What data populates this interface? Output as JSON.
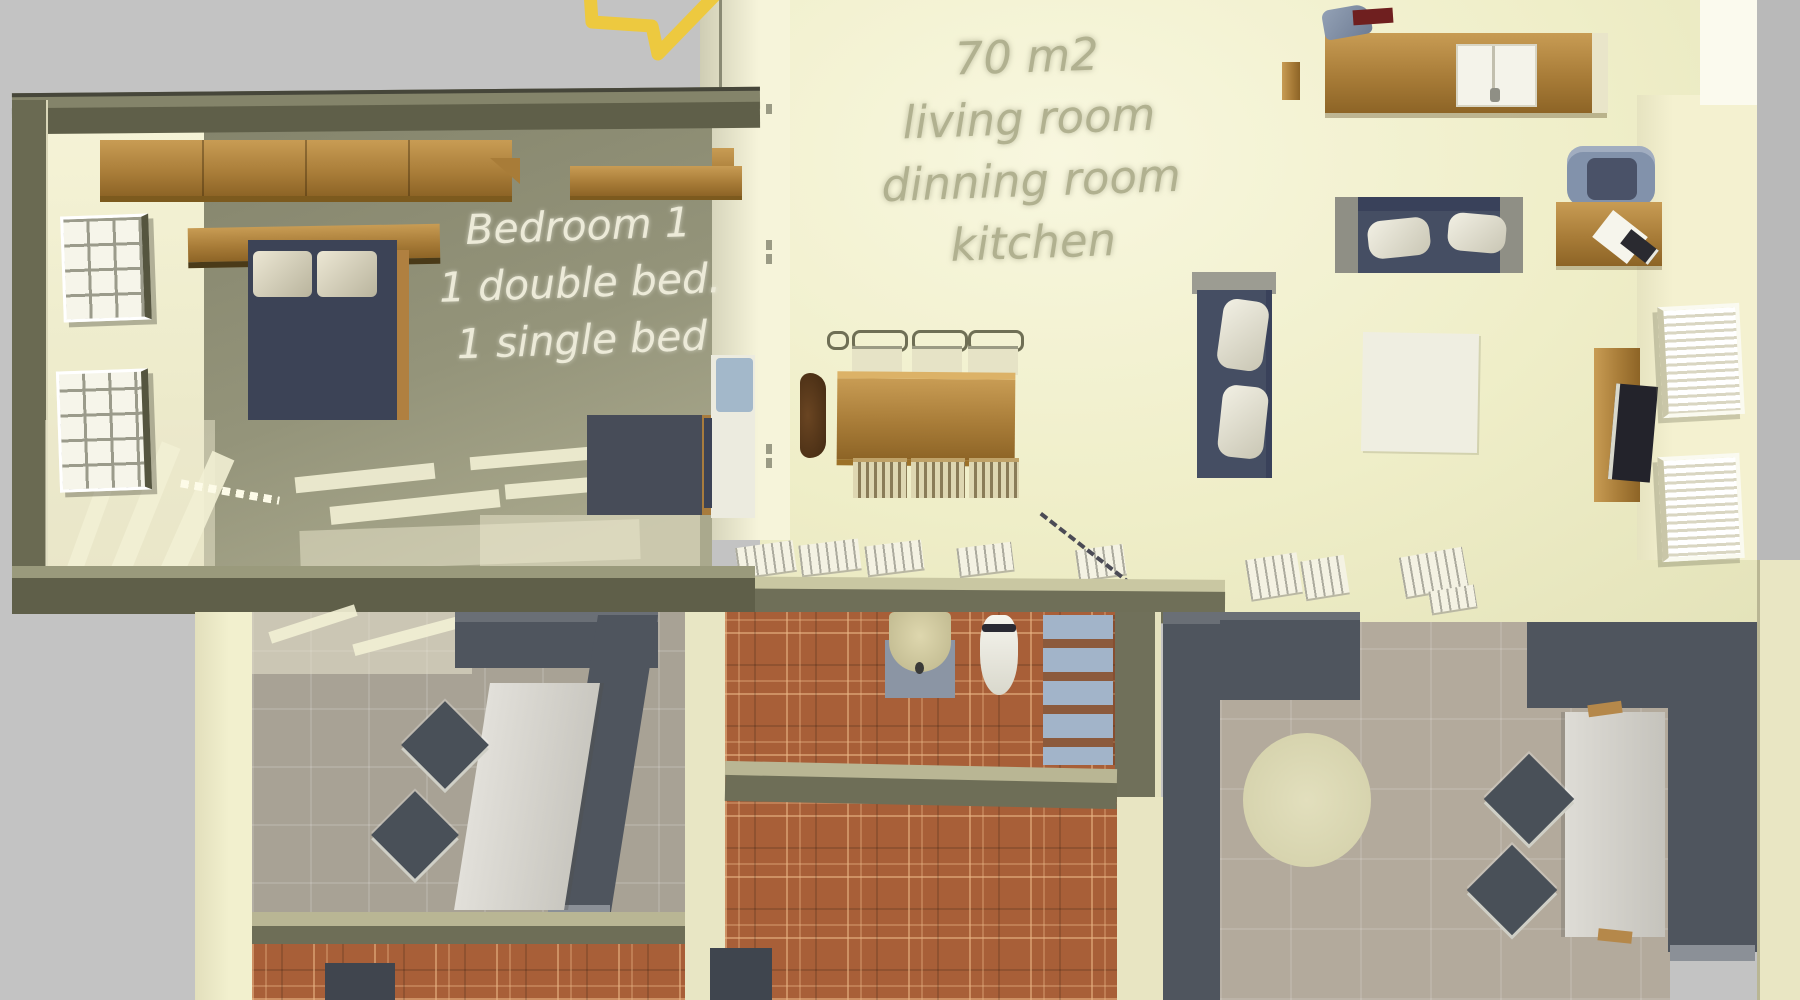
{
  "meta": {
    "kind": "3d-floorplan-aerial-render",
    "canvas_width": 1800,
    "canvas_height": 1000
  },
  "annotations": {
    "living_area": {
      "lines": [
        "70 m2",
        "living room",
        "dinning room",
        "kitchen"
      ],
      "text_color": "#b1b190"
    },
    "bedroom": {
      "lines": [
        "Bedroom 1",
        "1 double bed.",
        "1 single bed"
      ],
      "text_color": "#ecead8"
    },
    "arrow_marker_color": "#edc93f"
  },
  "colors": {
    "background_gray": "#c3c3c3",
    "wall_olive_dark": "#5f5f49",
    "wall_olive_light": "#84846a",
    "wall_cream": "#f1efcf",
    "living_floor_pale": "#efeec8",
    "wood": "#a87c38",
    "bed_navy": "#3c4356",
    "sofa_slate": "#454e63",
    "terracotta_tile": "#a85f38",
    "terrace_tile_gray": "#a8a295",
    "partition_dark": "#4f555e",
    "bath_shelf_blue": "#a2b4c9"
  },
  "furniture_icons": [
    "wardrobe",
    "double-bed",
    "bed-pillow",
    "headboard-shelf",
    "bedroom-window",
    "desk",
    "single-bed",
    "dining-table",
    "dining-chair",
    "wood-chair",
    "kitchen-counter",
    "kitchen-sink",
    "kettle",
    "serving-tray",
    "bar-stool",
    "sofa-vertical",
    "sofa-horizontal",
    "armchair",
    "side-table",
    "tv-stand",
    "tv-screen",
    "white-rug",
    "wall-window",
    "radiator",
    "wash-basin",
    "toilet",
    "towel-shelf",
    "terrace-table",
    "terrace-chair",
    "round-rug",
    "doormat"
  ]
}
